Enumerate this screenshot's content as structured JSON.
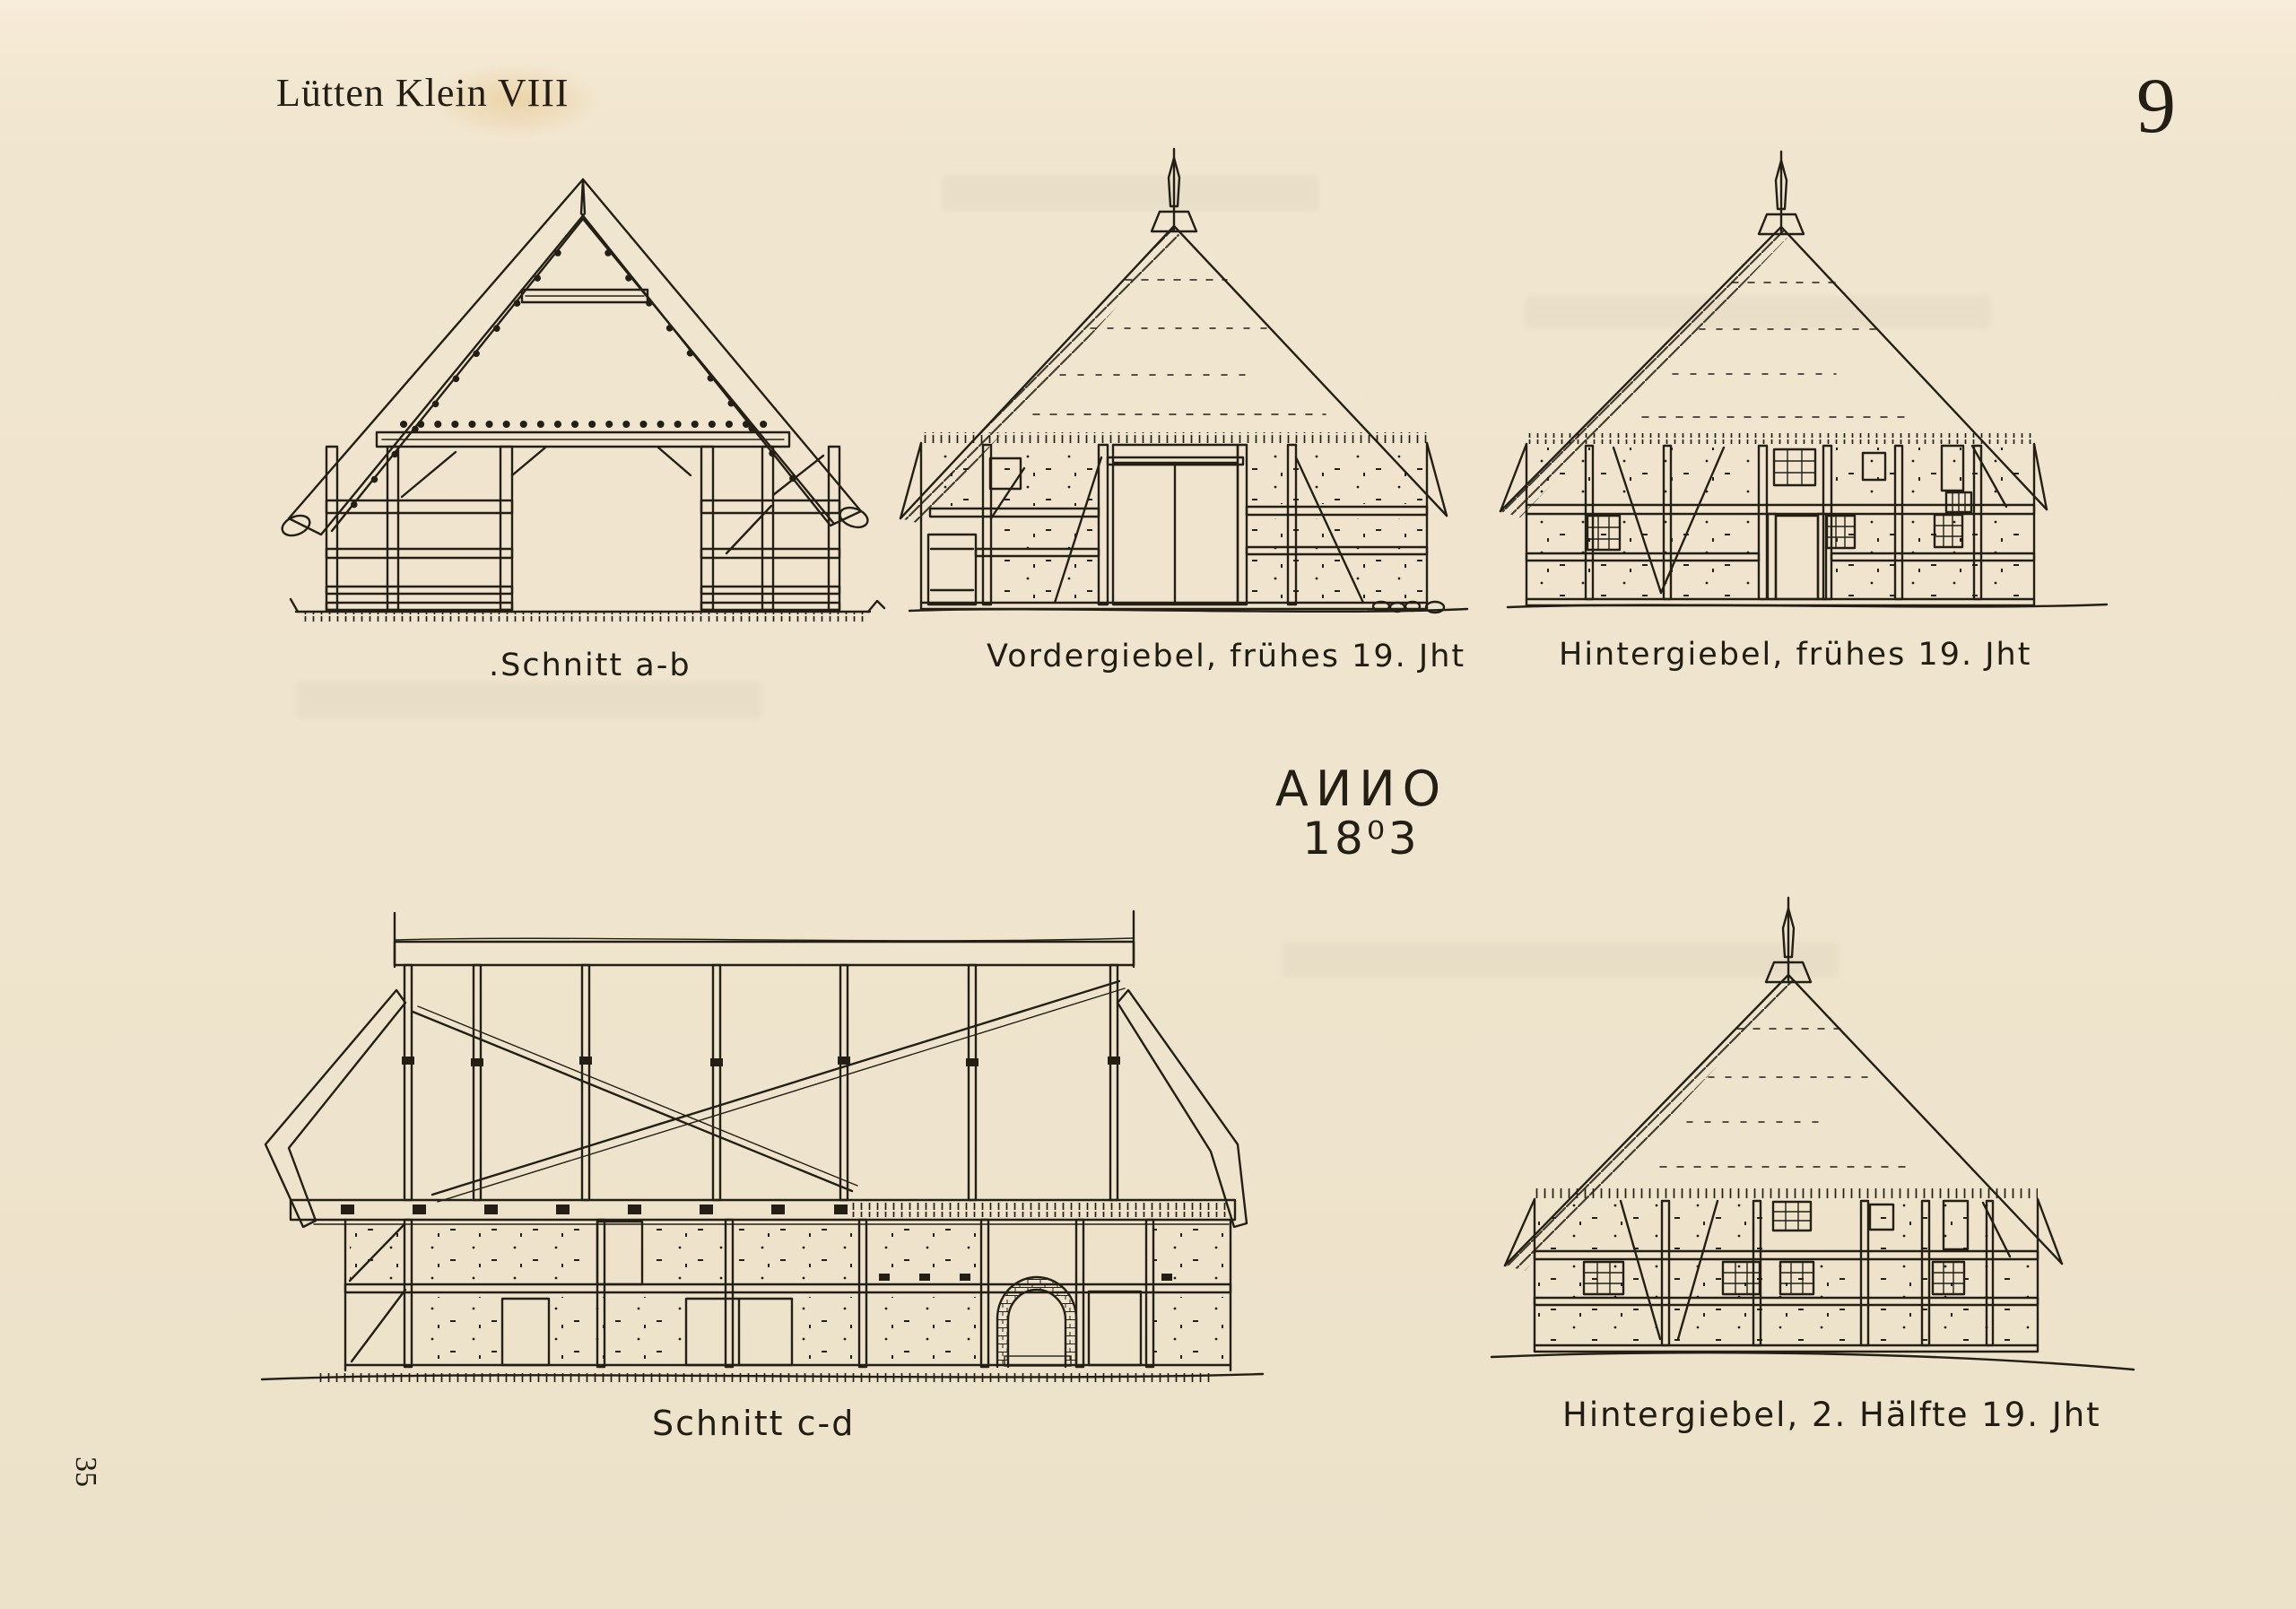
{
  "page": {
    "header_title": "Lütten Klein VIII",
    "page_number": "9",
    "margin_number": "35"
  },
  "inscription": {
    "line1": "AИИO",
    "line2": "18⁰3"
  },
  "figures": {
    "schnitt_ab": {
      "caption": ".Schnitt a-b"
    },
    "vordergiebel_early": {
      "caption": "Vordergiebel, frühes 19. Jht"
    },
    "hintergiebel_early": {
      "caption": "Hintergiebel, frühes 19. Jht"
    },
    "schnitt_cd": {
      "caption": "Schnitt c-d"
    },
    "hintergiebel_late": {
      "caption": "Hintergiebel, 2. Hälfte 19. Jht"
    }
  },
  "colors": {
    "paper": "#efe4cd",
    "ink": "#241f15"
  }
}
